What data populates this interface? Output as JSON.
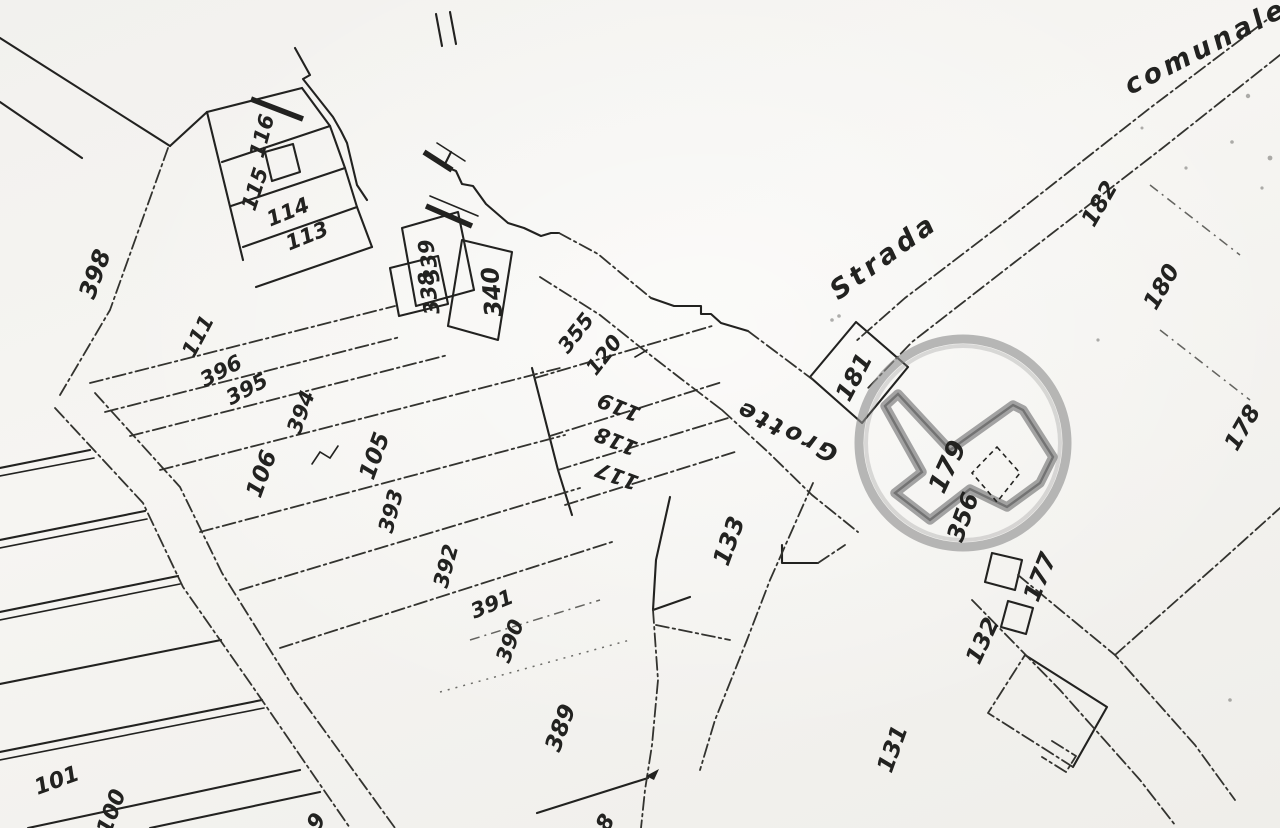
{
  "map": {
    "type": "cadastral-plan-scan",
    "colors": {
      "ink": "#222220",
      "ink_secondary": "#33332f",
      "paper": "#f4f3f0",
      "stamp_gray": "#8e8e8e",
      "highlight_gray": "#8a8a8a"
    },
    "road_labels": [
      {
        "text": "Strada",
        "x": 884,
        "y": 257,
        "rotation": -36,
        "size": 27
      },
      {
        "text": "comunale",
        "x": 1206,
        "y": 47,
        "rotation": -27,
        "size": 27
      },
      {
        "text": "Grotte",
        "x": 786,
        "y": 431,
        "rotation": 206,
        "size": 24
      }
    ],
    "parcel_labels": [
      {
        "text": "398",
        "x": 95,
        "y": 274,
        "rotation": -70,
        "size": 24
      },
      {
        "text": "116",
        "x": 262,
        "y": 136,
        "rotation": -75,
        "size": 21
      },
      {
        "text": "115",
        "x": 255,
        "y": 189,
        "rotation": -72,
        "size": 21
      },
      {
        "text": "114",
        "x": 288,
        "y": 212,
        "rotation": -22,
        "size": 21
      },
      {
        "text": "113",
        "x": 307,
        "y": 236,
        "rotation": -22,
        "size": 21
      },
      {
        "text": "111",
        "x": 198,
        "y": 336,
        "rotation": -62,
        "size": 21
      },
      {
        "text": "396",
        "x": 221,
        "y": 371,
        "rotation": -28,
        "size": 21
      },
      {
        "text": "395",
        "x": 247,
        "y": 389,
        "rotation": -28,
        "size": 21
      },
      {
        "text": "394",
        "x": 301,
        "y": 412,
        "rotation": -70,
        "size": 21
      },
      {
        "text": "106",
        "x": 262,
        "y": 474,
        "rotation": -70,
        "size": 23
      },
      {
        "text": "105",
        "x": 375,
        "y": 456,
        "rotation": -70,
        "size": 23
      },
      {
        "text": "393",
        "x": 391,
        "y": 511,
        "rotation": -75,
        "size": 21
      },
      {
        "text": "392",
        "x": 446,
        "y": 566,
        "rotation": -75,
        "size": 21
      },
      {
        "text": "391",
        "x": 492,
        "y": 604,
        "rotation": -22,
        "size": 21
      },
      {
        "text": "390",
        "x": 510,
        "y": 641,
        "rotation": -70,
        "size": 21
      },
      {
        "text": "389",
        "x": 561,
        "y": 728,
        "rotation": -70,
        "size": 23
      },
      {
        "text": "101",
        "x": 57,
        "y": 781,
        "rotation": -20,
        "size": 22
      },
      {
        "text": "100",
        "x": 112,
        "y": 812,
        "rotation": -70,
        "size": 22
      },
      {
        "text": "339",
        "x": 429,
        "y": 261,
        "rotation": -100,
        "size": 21
      },
      {
        "text": "338",
        "x": 429,
        "y": 293,
        "rotation": -100,
        "size": 21
      },
      {
        "text": "340",
        "x": 492,
        "y": 292,
        "rotation": -95,
        "size": 24
      },
      {
        "text": "355",
        "x": 576,
        "y": 333,
        "rotation": -52,
        "size": 21
      },
      {
        "text": "120",
        "x": 604,
        "y": 355,
        "rotation": -52,
        "size": 21
      },
      {
        "text": "119",
        "x": 619,
        "y": 407,
        "rotation": 202,
        "size": 21
      },
      {
        "text": "118",
        "x": 616,
        "y": 441,
        "rotation": 202,
        "size": 21
      },
      {
        "text": "117",
        "x": 617,
        "y": 476,
        "rotation": 200,
        "size": 21
      },
      {
        "text": "133",
        "x": 729,
        "y": 541,
        "rotation": -70,
        "size": 24
      },
      {
        "text": "181",
        "x": 854,
        "y": 377,
        "rotation": -62,
        "size": 24
      },
      {
        "text": "179",
        "x": 948,
        "y": 467,
        "rotation": -65,
        "size": 26
      },
      {
        "text": "356",
        "x": 963,
        "y": 517,
        "rotation": -70,
        "size": 24
      },
      {
        "text": "177",
        "x": 1040,
        "y": 577,
        "rotation": -68,
        "size": 24
      },
      {
        "text": "132",
        "x": 983,
        "y": 641,
        "rotation": -65,
        "size": 23
      },
      {
        "text": "131",
        "x": 893,
        "y": 749,
        "rotation": -70,
        "size": 23
      },
      {
        "text": "182",
        "x": 1100,
        "y": 204,
        "rotation": -60,
        "size": 23
      },
      {
        "text": "180",
        "x": 1162,
        "y": 287,
        "rotation": -60,
        "size": 23
      },
      {
        "text": "178",
        "x": 1243,
        "y": 428,
        "rotation": -60,
        "size": 23
      },
      {
        "text": "9",
        "x": 317,
        "y": 822,
        "rotation": -60,
        "size": 22
      },
      {
        "text": "8",
        "x": 606,
        "y": 823,
        "rotation": -60,
        "size": 22
      }
    ],
    "stamp": {
      "cx": 963,
      "cy": 443,
      "r": 104
    },
    "highlighted_building": {
      "points": "898,394 950,450 1013,405 1023,410 1053,457 1040,483 1007,507 970,489 930,520 895,493 922,472 885,406"
    },
    "inner_parcel_diamond": {
      "points": "997,447 1020,473 997,502 972,473"
    }
  }
}
